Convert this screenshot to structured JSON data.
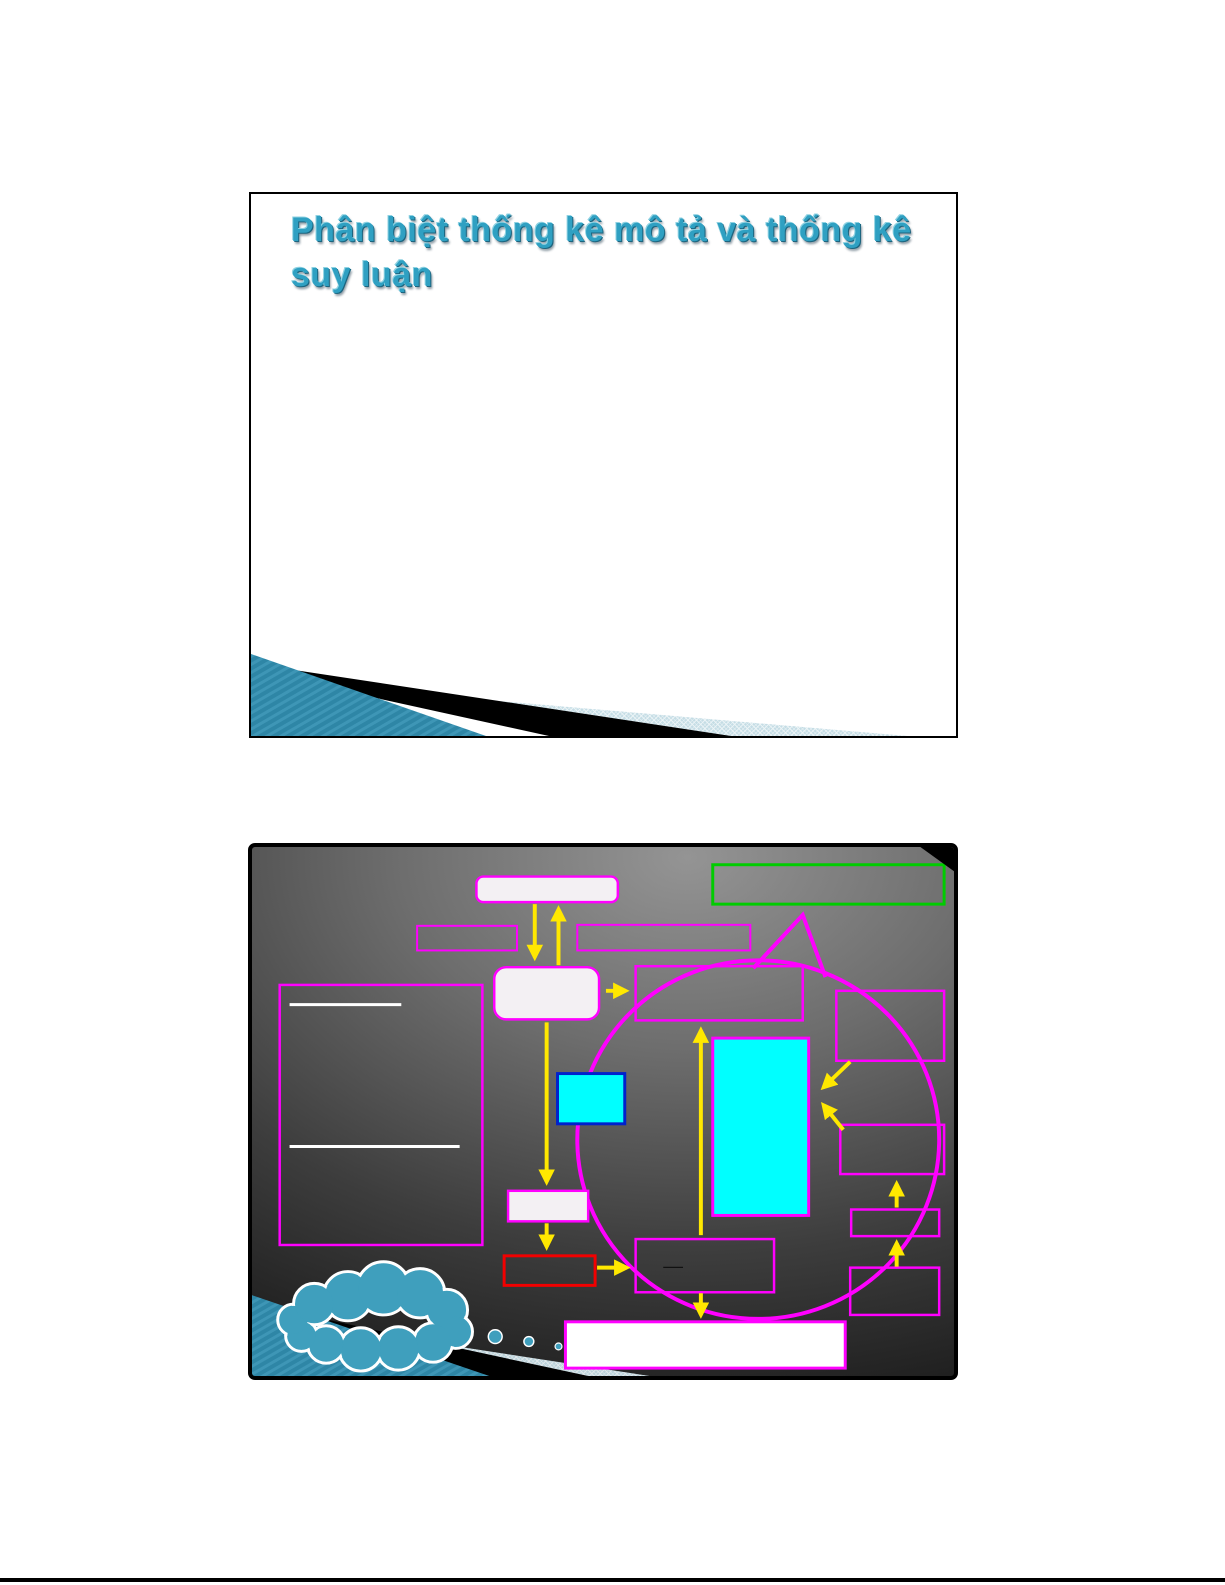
{
  "slide1": {
    "title": "Phân biệt thống kê mô tả và thống kê suy luận"
  },
  "slide2": {
    "box_dash": "—"
  },
  "colors": {
    "title": "#2fa0c2",
    "magenta": "#ff00ff",
    "green": "#00cc00",
    "yellow": "#ffe800",
    "cyan": "#00ffff",
    "blue": "#0022cc",
    "red": "#f20000",
    "boxfill": "#f3f0f3",
    "white": "#ffffff",
    "cloud": "#3f9fbd",
    "ribbon_teal": "#2e86a6",
    "ribbon_stripe": "#3e96b6",
    "ribbon_hatch": "#c2dbe4",
    "bg_light": "#949494",
    "bg_dark": "#141414",
    "page_rule": "#000000"
  }
}
